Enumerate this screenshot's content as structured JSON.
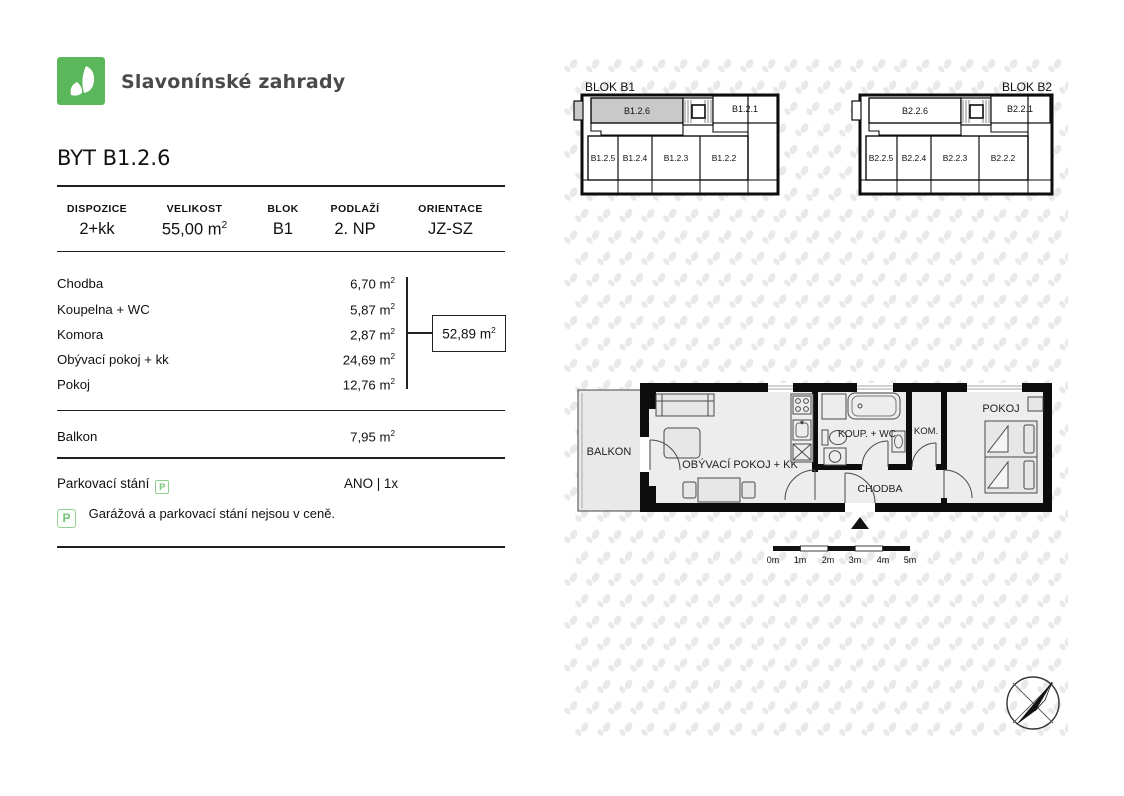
{
  "header": {
    "brand": "Slavonínské zahrady"
  },
  "unit": {
    "title": "BYT B1.2.6"
  },
  "units": {
    "base": "m",
    "sup": "2"
  },
  "summary": {
    "columns": [
      {
        "label": "DISPOZICE",
        "value": "2+kk"
      },
      {
        "label": "VELIKOST",
        "value": "55,00"
      },
      {
        "label": "BLOK",
        "value": "B1"
      },
      {
        "label": "PODLAŽÍ",
        "value": "2. NP"
      },
      {
        "label": "ORIENTACE",
        "value": "JZ-SZ"
      }
    ]
  },
  "rooms": [
    {
      "label": "Chodba",
      "value": "6,70"
    },
    {
      "label": "Koupelna + WC",
      "value": "5,87"
    },
    {
      "label": "Komora",
      "value": "2,87"
    },
    {
      "label": "Obývací pokoj + kk",
      "value": "24,69"
    },
    {
      "label": "Pokoj",
      "value": "12,76"
    }
  ],
  "total": {
    "value": "52,89"
  },
  "balcony": {
    "label": "Balkon",
    "value": "7,95"
  },
  "parking": {
    "label": "Parkovací stání",
    "icon_letter": "P",
    "value": "ANO | 1x",
    "note": "Garážová a parkovací stání nejsou v ceně."
  },
  "blocks": [
    {
      "title": "BLOK B1",
      "top": [
        "B1.2.6",
        "B1.2.1"
      ],
      "bottom": [
        "B1.2.5",
        "B1.2.4",
        "B1.2.3",
        "B1.2.2"
      ],
      "highlighted_unit": "B1.2.6"
    },
    {
      "title": "BLOK B2",
      "top": [
        "B2.2.6",
        "B2.2.1"
      ],
      "bottom": [
        "B2.2.5",
        "B2.2.4",
        "B2.2.3",
        "B2.2.2"
      ]
    }
  ],
  "floorplan": {
    "labels": {
      "balkon": "BALKON",
      "living": "OBÝVACÍ POKOJ + KK",
      "bath": "KOUP. + WC",
      "storage": "KOM.",
      "hall": "CHODBA",
      "bedroom": "POKOJ"
    },
    "scale": [
      "0m",
      "1m",
      "2m",
      "3m",
      "4m",
      "5m"
    ]
  },
  "colors": {
    "brand_green": "#5bb75b",
    "highlight_gray": "#c9c9c9",
    "watermark_gray": "#e9e9e9",
    "wall_black": "#0d0d0d"
  }
}
